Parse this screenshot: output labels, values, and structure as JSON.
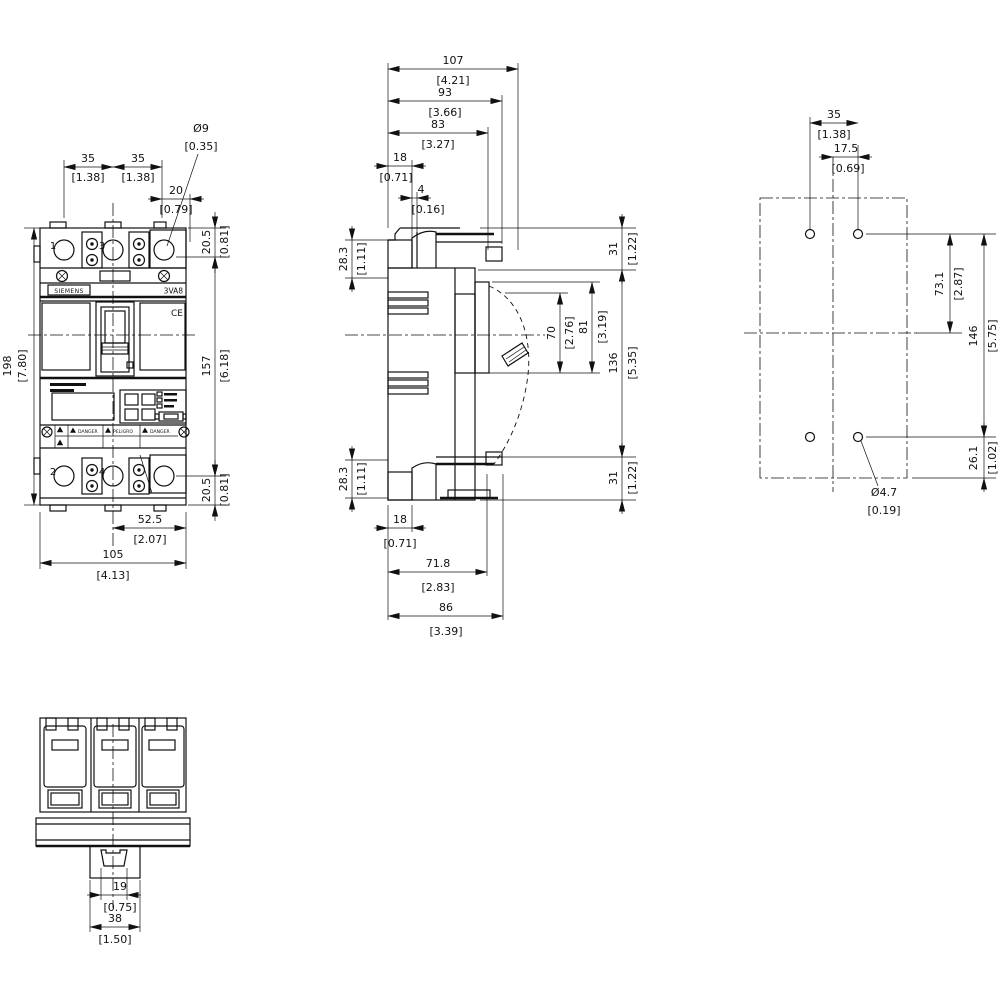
{
  "labels": {
    "brand": "SIEMENS",
    "model": "3VA8",
    "ce": "CE",
    "warn_left": "DANGER",
    "warn_mid": "PELIGRO",
    "warn_right": "DANGER",
    "pole1": "1",
    "pole3": "3",
    "pole2": "2",
    "pole4": "4"
  },
  "front": {
    "pole_pitch_1": {
      "mm": "35",
      "inch": "[1.38]"
    },
    "pole_pitch_2": {
      "mm": "35",
      "inch": "[1.38]"
    },
    "edge_offset": {
      "mm": "20",
      "inch": "[0.79]"
    },
    "terminal_hole": {
      "mm": "Ø9",
      "inch": "[0.35]"
    },
    "terminal_top": {
      "mm": "20.5",
      "inch": "[0.81]"
    },
    "cover_height": {
      "mm": "157",
      "inch": "[6.18]"
    },
    "terminal_bottom": {
      "mm": "20.5",
      "inch": "[0.81]"
    },
    "total_height": {
      "mm": "198",
      "inch": "[7.80]"
    },
    "half_width": {
      "mm": "52.5",
      "inch": "[2.07]"
    },
    "total_width": {
      "mm": "105",
      "inch": "[4.13]"
    }
  },
  "side": {
    "depth_total": {
      "mm": "107",
      "inch": "[4.21]"
    },
    "depth_93": {
      "mm": "93",
      "inch": "[3.66]"
    },
    "depth_83": {
      "mm": "83",
      "inch": "[3.27]"
    },
    "top_18": {
      "mm": "18",
      "inch": "[0.71]"
    },
    "top_4": {
      "mm": "4",
      "inch": "[0.16]"
    },
    "term_top": {
      "mm": "28.3",
      "inch": "[1.11]"
    },
    "h31_top": {
      "mm": "31",
      "inch": "[1.22]"
    },
    "handle_70": {
      "mm": "70",
      "inch": "[2.76]"
    },
    "handle_81": {
      "mm": "81",
      "inch": "[3.19]"
    },
    "h136": {
      "mm": "136",
      "inch": "[5.35]"
    },
    "h31_bottom": {
      "mm": "31",
      "inch": "[1.22]"
    },
    "term_bottom": {
      "mm": "28.3",
      "inch": "[1.11]"
    },
    "bottom_18": {
      "mm": "18",
      "inch": "[0.71]"
    },
    "bottom_71_8": {
      "mm": "71.8",
      "inch": "[2.83]"
    },
    "bottom_86": {
      "mm": "86",
      "inch": "[3.39]"
    }
  },
  "drill": {
    "hole_pitch_35": {
      "mm": "35",
      "inch": "[1.38]"
    },
    "hole_17_5": {
      "mm": "17.5",
      "inch": "[0.69]"
    },
    "v73_1": {
      "mm": "73.1",
      "inch": "[2.87]"
    },
    "v146": {
      "mm": "146",
      "inch": "[5.75]"
    },
    "v26_1": {
      "mm": "26.1",
      "inch": "[1.02]"
    },
    "hole_dia": {
      "mm": "Ø4.7",
      "inch": "[0.19]"
    }
  },
  "bottom": {
    "din_19": {
      "mm": "19",
      "inch": "[0.75]"
    },
    "din_38": {
      "mm": "38",
      "inch": "[1.50]"
    }
  }
}
